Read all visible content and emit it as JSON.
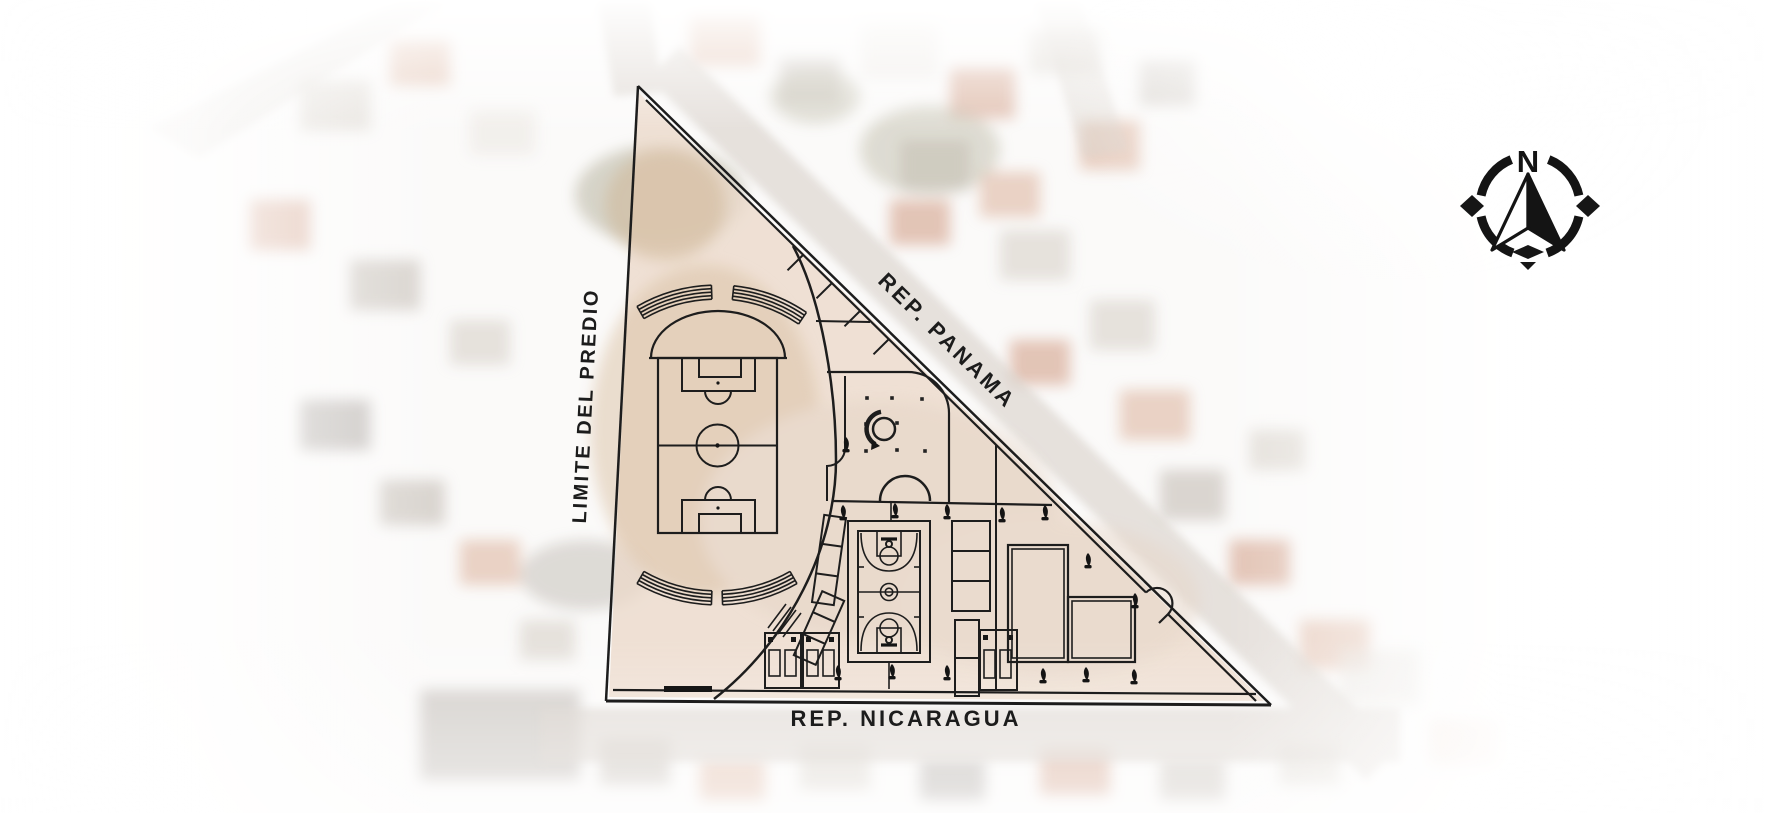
{
  "page": {
    "description": "Architectural site plan of a triangular sports park drawn over a faded aerial photograph"
  },
  "labels": {
    "street_diagonal": "REP. PANAMA",
    "street_bottom": "REP. NICARAGUA",
    "site_boundary": "LIMITE DEL PREDIO"
  },
  "compass": {
    "cardinal_letter": "N"
  },
  "colors": {
    "plan_line": "#1d1d1d",
    "site_fill": "#ead9c9",
    "street_fill": "#d5cec6",
    "roof_terracotta": "#c98a6e",
    "label_text": "#1c1c1c",
    "background": "#ffffff"
  },
  "features": [
    "site-boundary-triangle",
    "curved-walkway",
    "soccer-field",
    "grandstand-arc",
    "basketball-court",
    "central-plaza",
    "fountain-sculpture",
    "amphitheater-stage",
    "bleacher-stand",
    "exercise-equipment-room",
    "multipurpose-court",
    "sidewalk-expansion-joints",
    "gate-swing",
    "tree",
    "bollard",
    "north-compass"
  ]
}
